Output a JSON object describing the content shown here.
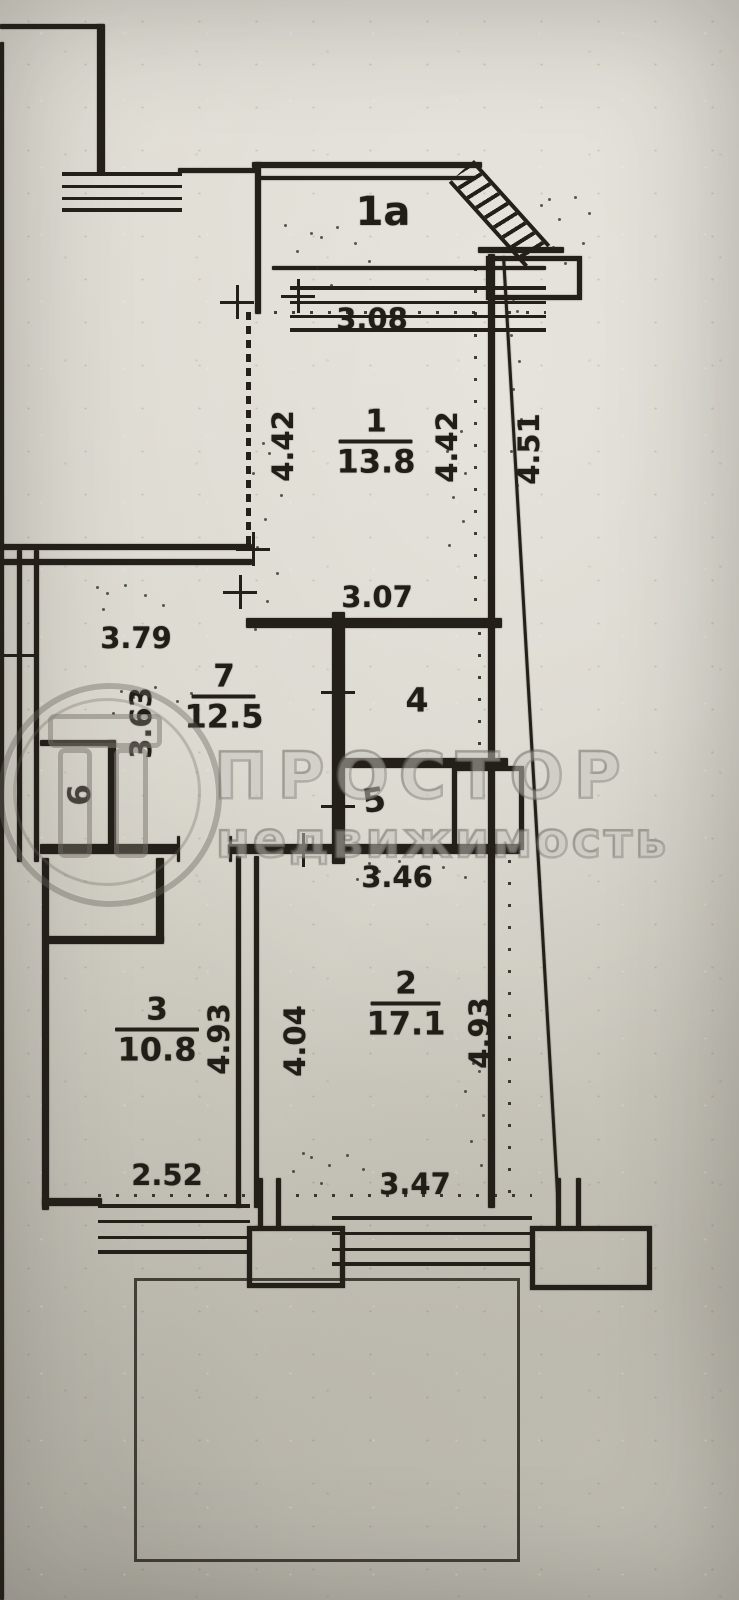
{
  "watermark": {
    "brand": "ПРОСТОР",
    "subtitle": "недвижимость"
  },
  "rooms": {
    "r1a": {
      "number": "1а"
    },
    "r1": {
      "number": "1",
      "area": "13.8"
    },
    "r2": {
      "number": "2",
      "area": "17.1"
    },
    "r3": {
      "number": "3",
      "area": "10.8"
    },
    "r4": {
      "number": "4"
    },
    "r5": {
      "number": "5"
    },
    "r6": {
      "number": "6"
    },
    "r7": {
      "number": "7",
      "area": "12.5"
    }
  },
  "dims": {
    "balcony_width": "3.08",
    "room1_left": "4.42",
    "room1_right": "4.42",
    "outer_right_height": "4.51",
    "room1_bottom": "3.07",
    "room7_top": "3.79",
    "room7_left": "3.63",
    "hall_width": "3.46",
    "room3_height": "4.93",
    "room2_left": "4.04",
    "room2_height": "4.93",
    "room3_bottom": "2.52",
    "room2_bottom": "3.47"
  },
  "colors": {
    "ink": "#242019",
    "paper": "#dad7cd"
  }
}
